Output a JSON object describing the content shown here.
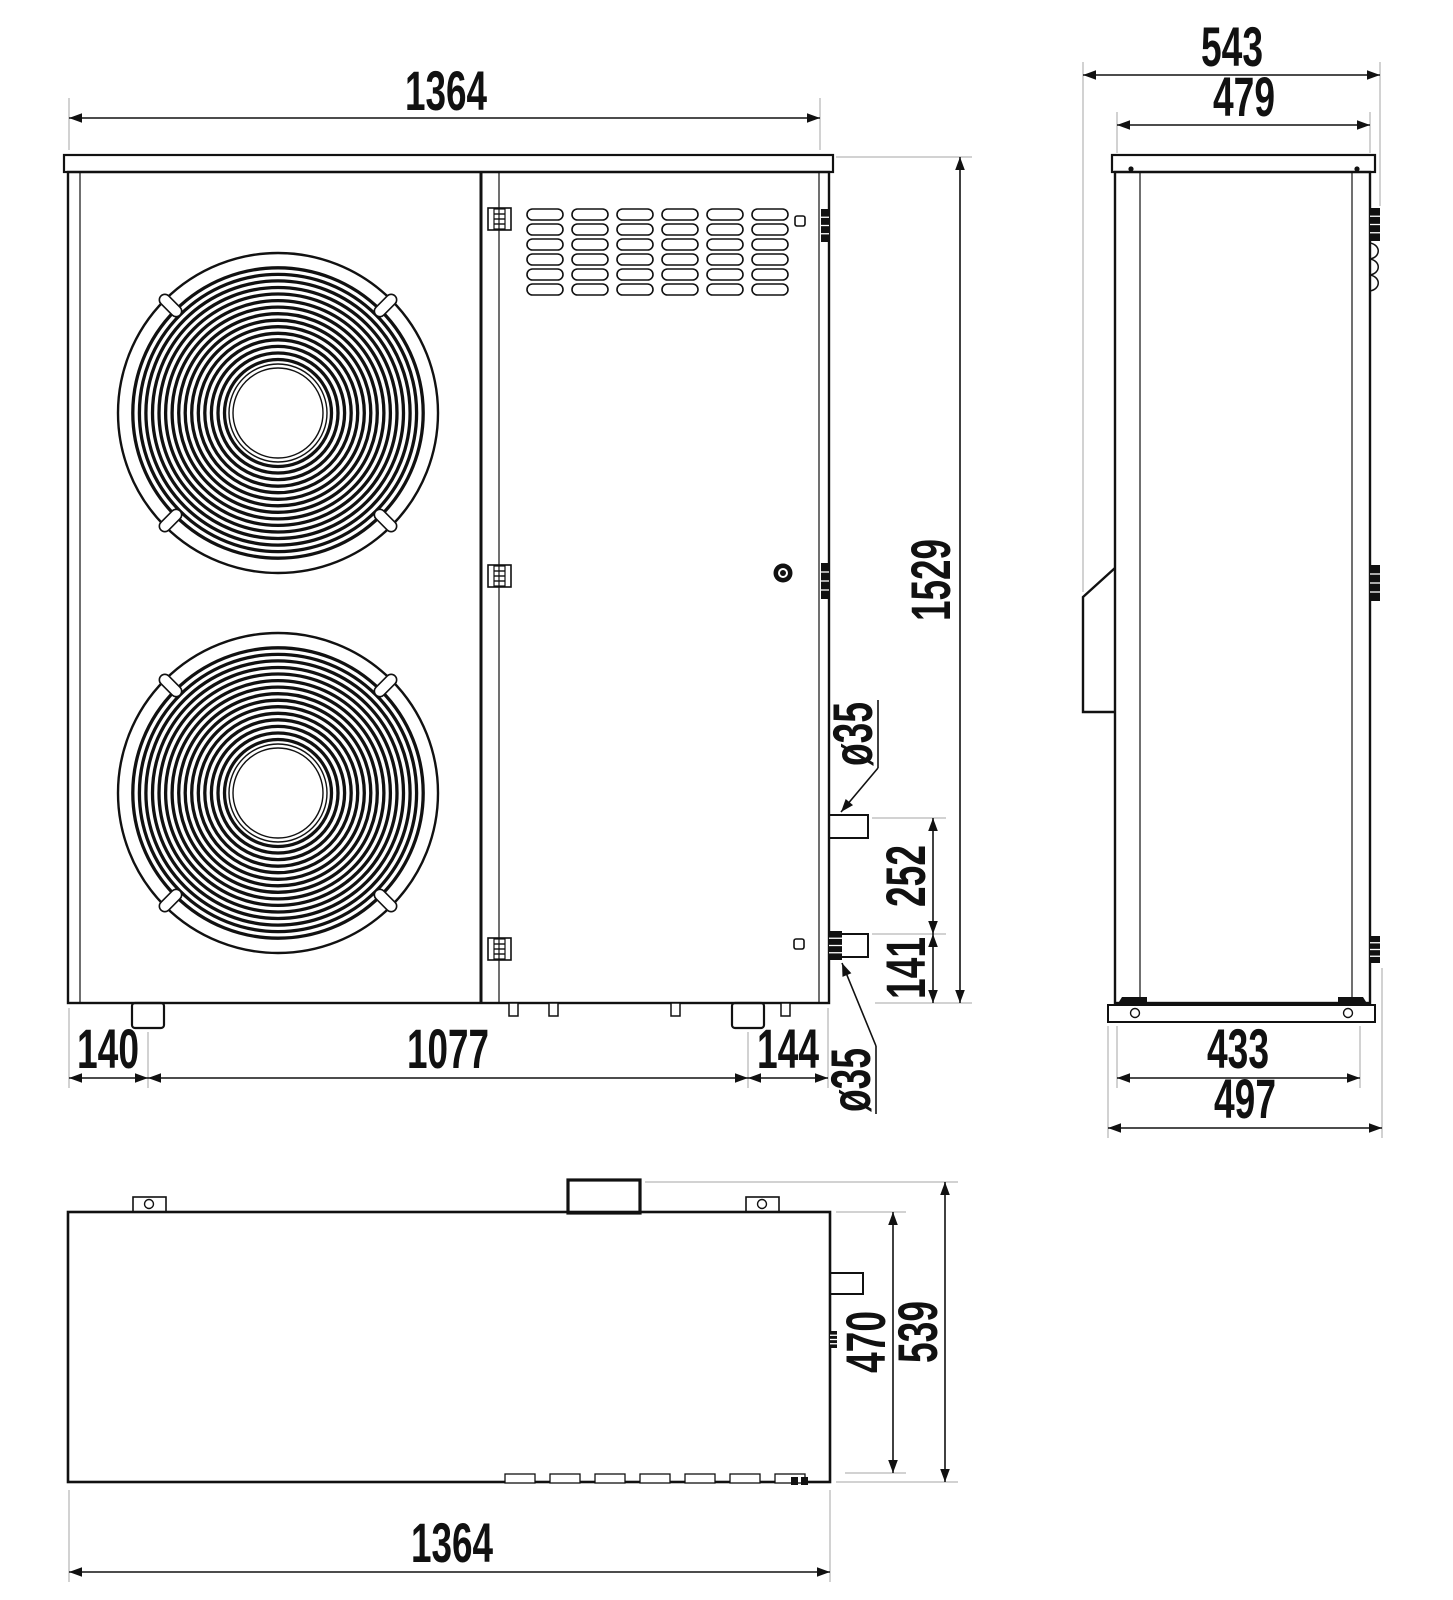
{
  "views": {
    "front": {
      "width_label": "1364",
      "height_label": "1529",
      "foot_left_label": "140",
      "feet_span_label": "1077",
      "foot_right_label": "144",
      "pipe_spacing_label": "252",
      "pipe_bottom_height_label": "141",
      "pipe_top_diameter_label": "ø35",
      "pipe_bottom_diameter_label": "ø35"
    },
    "side": {
      "depth_overall_label": "543",
      "depth_body_label": "479",
      "base_span_label": "433",
      "base_width_label": "497"
    },
    "top": {
      "width_label": "1364",
      "depth_body_label": "470",
      "depth_overall_label": "539"
    }
  }
}
